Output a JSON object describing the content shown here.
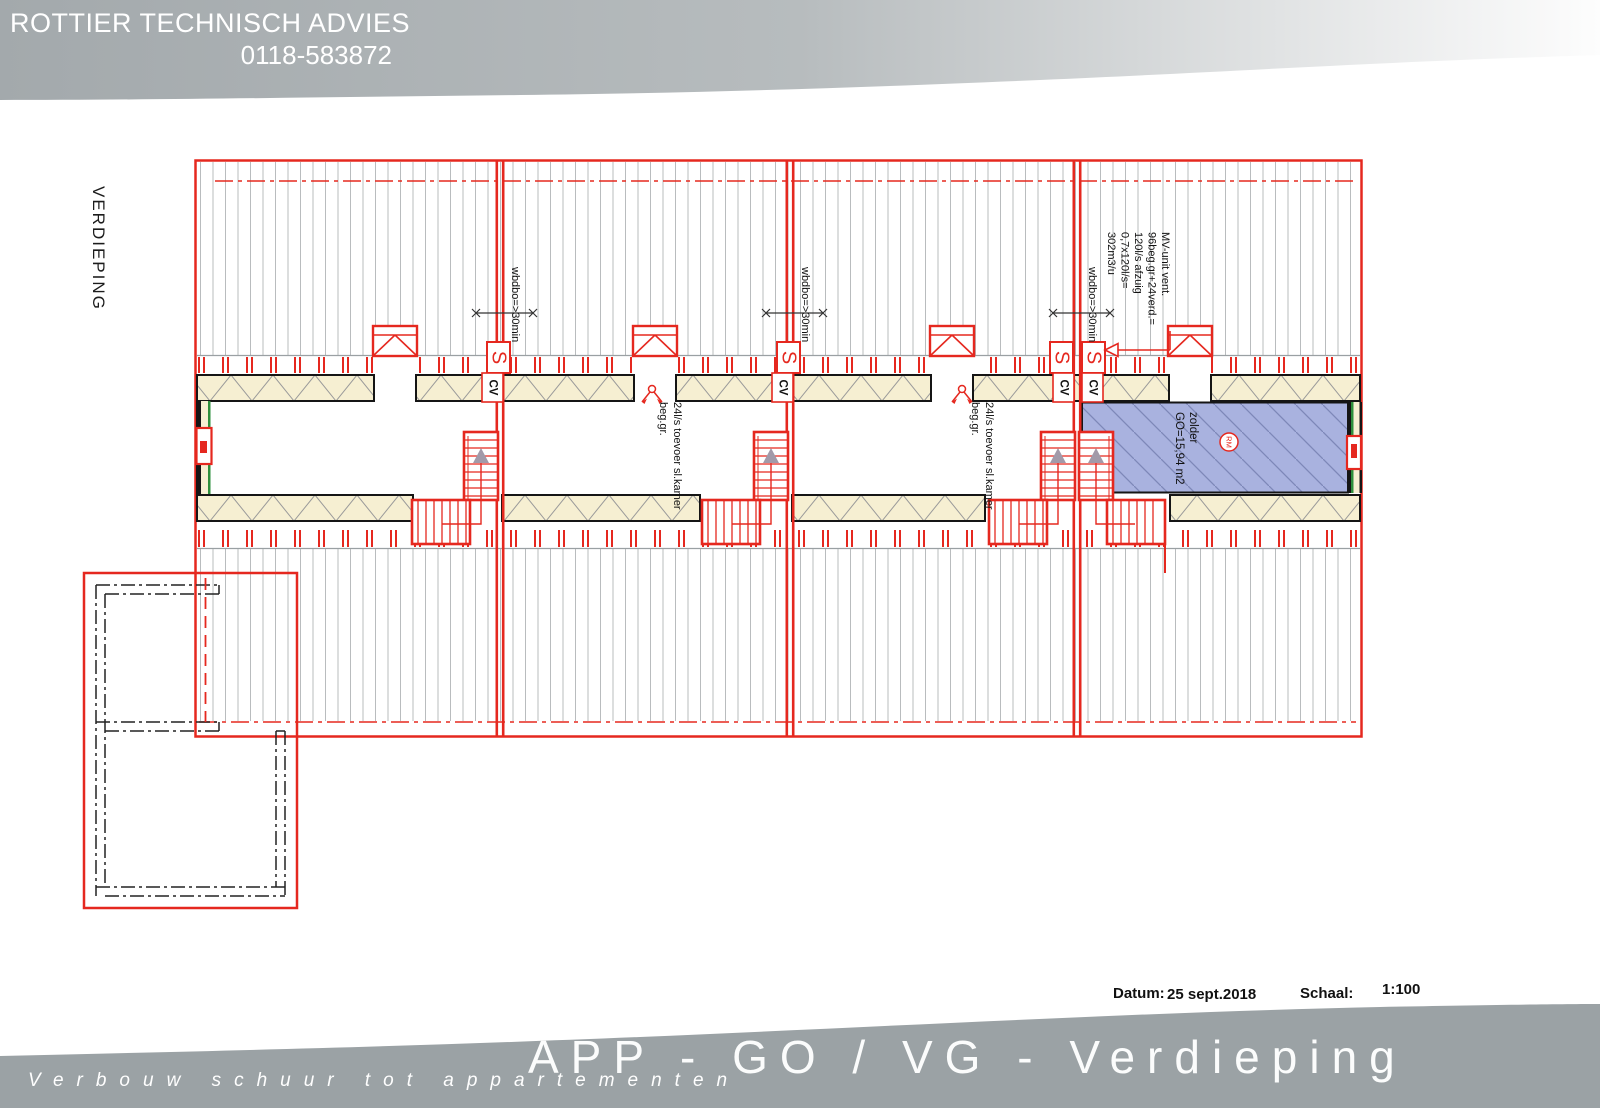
{
  "header": {
    "company": "ROTTIER TECHNISCH ADVIES",
    "phone": "0118-583872"
  },
  "floor_label": "VERDIEPING",
  "plan": {
    "wbdbo": "wbdbo=>30min",
    "mv_lines": [
      "MV-unit vent.",
      "96beg.gr+24verd.=",
      "120l/s afzuig",
      "0,7x120l/s=",
      "302m3/u"
    ],
    "toevoer_line1": "24l/s toevoer sl.kamer",
    "toevoer_line2": "beg.gr.",
    "zolder_name": "zolder",
    "zolder_area": "GO=15,94 m2",
    "smoke_detector": "RM",
    "shaft_symbol": "S",
    "cv_label": "CV"
  },
  "titleblock": {
    "datum_label": "Datum:",
    "datum_value": "25 sept.2018",
    "schaal_label": "Schaal:",
    "schaal_value": "1:100"
  },
  "footer": {
    "title": "APP - GO / VG - Verdieping",
    "subtitle": "Verbouw schuur tot appartementen"
  },
  "colors": {
    "drawing_red": "#e5281f",
    "insulation_cream": "#f6efd2",
    "attic_blue": "#a9b2df",
    "banner_gray": "#9ba2a5",
    "wall_green": "#2e8f3c"
  }
}
